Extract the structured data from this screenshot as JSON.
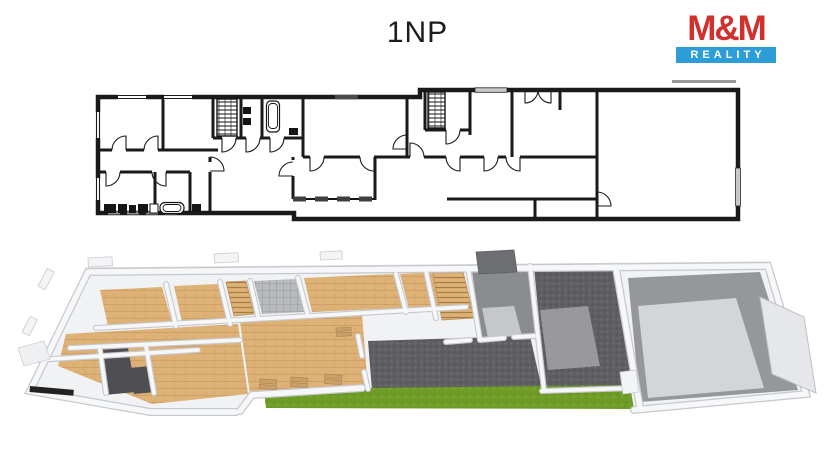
{
  "header": {
    "title": "1NP"
  },
  "logo": {
    "top": "M&M",
    "bottom": "REALITY"
  },
  "colors": {
    "title": "#1c1c1c",
    "logo_red": "#d2302c",
    "logo_blue": "#2d9dd8",
    "line": "#1a1a1a",
    "wall3d": "#f6f7f9",
    "wall3d_edge": "#c7c8cc",
    "base3d": "#f1f2f4",
    "wood": "#deb176",
    "wood_line": "#c1935a",
    "steps_line": "#a87c45",
    "tile": "#b9babe",
    "tile_line": "#a3a4a8",
    "paving": "#5e5e63",
    "paving_dot": "#74747a",
    "paving_light": "#9e9fa3",
    "entry_floor": "#8b8c90",
    "entry_patch": "#c6c7c9",
    "closet": "#4e4e53",
    "garage_border": "#96979b",
    "garage_floor": "#d4d5d7",
    "grass": "#6f9c26",
    "grass_dark": "#5f8a1d",
    "grass_light": "#83b133",
    "slab_dark": "#6e6f73",
    "sill_wood": "#caa06a"
  }
}
